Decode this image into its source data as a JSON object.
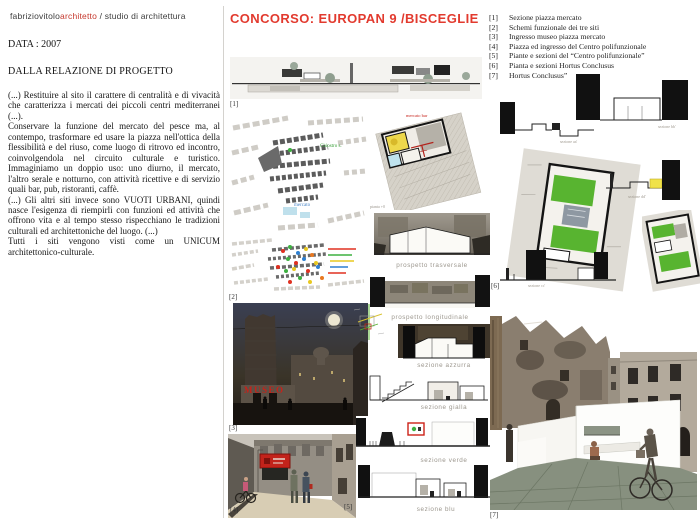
{
  "header": {
    "brand_name": "fabriziovitolo",
    "brand_accent": "architetto",
    "brand_suffix": " / studio di architettura",
    "date": "DATA : 2007",
    "section_heading": "DALLA RELAZIONE DI PROGETTO"
  },
  "title": "CONCORSO: EUROPAN 9 /BISCEGLIE",
  "relazione": {
    "paragraphs": [
      "(...) Restituire al sito il carattere di centralità e di vivacità che caratterizza i mercati dei piccoli centri mediterranei (...).",
      "Conservare la funzione del mercato del pesce ma, al contempo, trasformare ed usare la piazza nell'ottica della flessibilità e del riuso, come luogo di ritrovo ed incontro, coinvolgendola nel circuito culturale e turistico. Immaginiamo un doppio uso: uno diurno, il mercato, l'altro serale e notturno, con attività ricettive e di servizio quali bar, pub, ristoranti, caffè.",
      "(...) Gli altri siti invece sono VUOTI URBANI, quindi nasce l'esigenza di riempirli con funzioni ed attività che offrono vita e al tempo stesso rispecchiano le tradizioni culturali ed architettoniche del luogo. (...)",
      "Tutti i siti vengono visti come un UNICUM architettonico-culturale."
    ]
  },
  "legend": {
    "items": [
      {
        "num": "[1]",
        "text": "Sezione piazza mercato"
      },
      {
        "num": "[2]",
        "text": "Schemi funzionale dei tre siti"
      },
      {
        "num": "[3]",
        "text": "Ingresso museo piazza mercato"
      },
      {
        "num": "[4]",
        "text": "Piazza ed ingresso del Centro polifunzionale"
      },
      {
        "num": "[5]",
        "text": "Piante e sezioni del “Centro polifunzionale”"
      },
      {
        "num": "[6]",
        "text": "Pianta e sezioni Hortus Conclusus"
      },
      {
        "num": "[7]",
        "text": "Hortus Conclusus”"
      }
    ]
  },
  "figures": {
    "labels": {
      "f1": "[1]",
      "f2": "[2]",
      "f3": "[3]",
      "f4": "[4]",
      "f5": "[5]",
      "f6": "[6]",
      "f7": "[7]"
    }
  },
  "captions": {
    "museo_sign": "MUSEO",
    "map_label_green": "Chiostro s.",
    "map_label_blue": "mercato",
    "mercato_bar": "mercato bar",
    "pianta_quota": "pianta +0",
    "prospetto_trasversale": "prospetto trasversale",
    "prospetto_longitudinale": "prospetto longitudinale",
    "sezione_azzurra": "sezione azzurra",
    "sezione_gialla": "sezione gialla",
    "sezione_verde": "sezione verde",
    "sezione_blu": "sezione blu",
    "sezione_aa": "sezione aa'",
    "sezione_bb": "sezione bb'",
    "sezione_cc": "sezione cc'",
    "sezione_dd": "sezione dd'"
  },
  "colors": {
    "accent_red": "#e23a2e",
    "caption_gray": "#9b968d",
    "verde": "#58b430",
    "giallo": "#f0e24a",
    "azzurro": "#bfe3ee"
  }
}
